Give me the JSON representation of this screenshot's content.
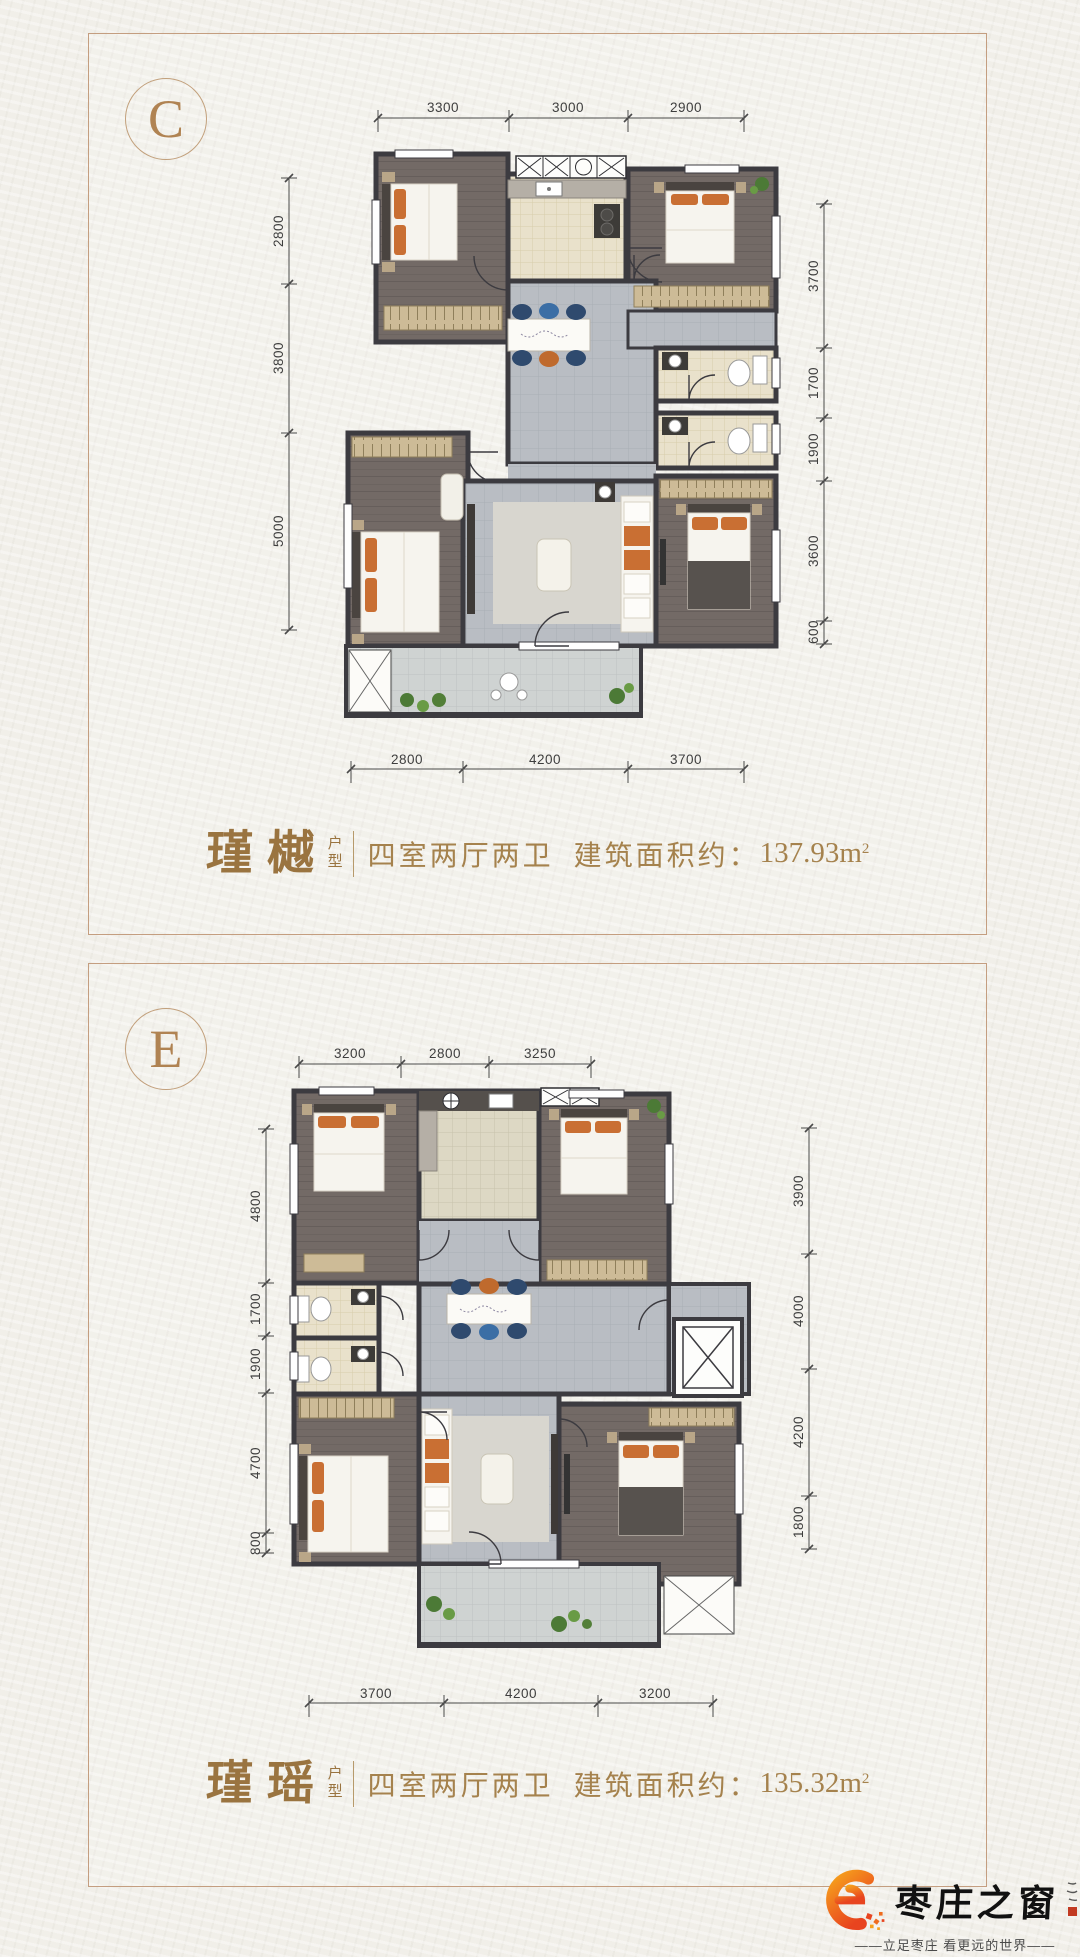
{
  "page": {
    "background": "#f1efe9",
    "accent_brown": "#9a7440",
    "border_tan": "#c49e80"
  },
  "cards": [
    {
      "badge": "C",
      "title": "瑾樾",
      "suffix_top": "户",
      "suffix_bottom": "型",
      "desc": "四室两厅两卫",
      "area_label": "建筑面积约：",
      "area_value": "137.93m",
      "area_sup": "2",
      "dims_top": [
        "3300",
        "3000",
        "2900"
      ],
      "dims_left": [
        "2800",
        "3800",
        "5000"
      ],
      "dims_right": [
        "3700",
        "1700",
        "1900",
        "3600",
        "600"
      ],
      "dims_bottom": [
        "2800",
        "4200",
        "3700"
      ]
    },
    {
      "badge": "E",
      "title": "瑾瑶",
      "suffix_top": "户",
      "suffix_bottom": "型",
      "desc": "四室两厅两卫",
      "area_label": "建筑面积约：",
      "area_value": "135.32m",
      "area_sup": "2",
      "dims_top": [
        "3200",
        "2800",
        "3250"
      ],
      "dims_left": [
        "4800",
        "1700",
        "1900",
        "4700",
        "800"
      ],
      "dims_right": [
        "3900",
        "4000",
        "4200",
        "1800"
      ],
      "dims_bottom": [
        "3700",
        "4200",
        "3200"
      ]
    }
  ],
  "footer": {
    "brand": "枣庄之窗",
    "tagline": "——立足枣庄  看更远的世界——",
    "logo_color_top": "#f6a21c",
    "logo_color_bottom": "#e8441f"
  }
}
